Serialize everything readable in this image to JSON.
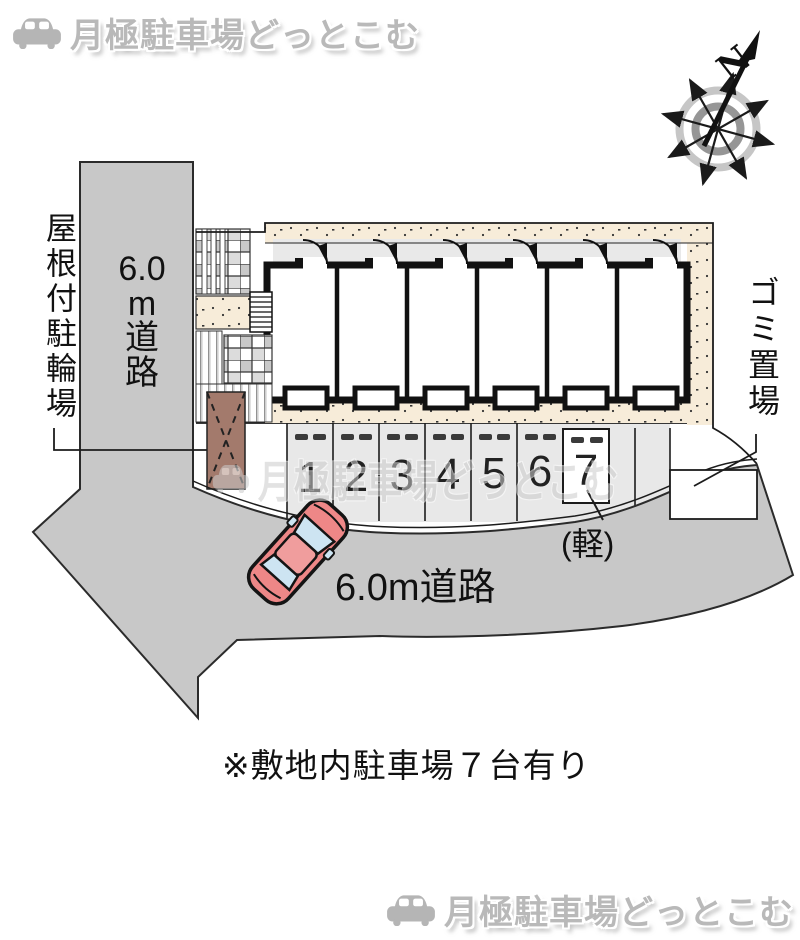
{
  "header": {
    "logo_text": "月極駐車場どっとこむ"
  },
  "footer": {
    "logo_text": "月極駐車場どっとこむ"
  },
  "compass": {
    "north_label": "N"
  },
  "site": {
    "covered_bicycle_label": "屋根付駐輪場",
    "side_road_label_parts": [
      "6.0",
      "m",
      "道",
      "路"
    ],
    "side_road_label": "6.0m道路",
    "front_road_label": "6.0m道路",
    "garbage_label": "ゴミ置場",
    "kei_note": "(軽)",
    "parking_numbers": [
      "1",
      "2",
      "3",
      "4",
      "5",
      "6",
      "7"
    ],
    "watermark_text": "月極駐車場どっとこむ",
    "site_note": "※敷地内駐車場７台有り"
  },
  "colors": {
    "road_gray": "#c8c8c8",
    "beige": "#f7ecd9",
    "parking_gray": "#e8e8e8",
    "bicycle_brown": "#a37a6c",
    "car_red": "#ee8787",
    "car_window_blue": "#cde4f2",
    "logo_gray": "#b9b9b9"
  }
}
